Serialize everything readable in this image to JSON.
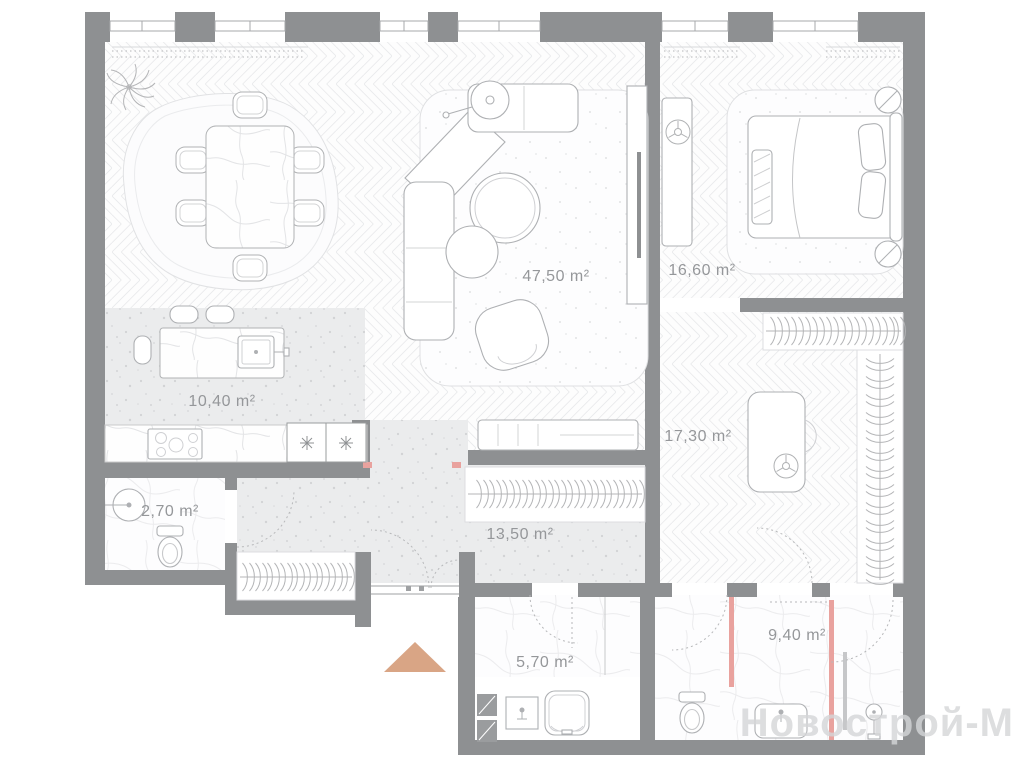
{
  "plan": {
    "watermark": "Новострой-М",
    "rooms": [
      {
        "name": "living-dining-room",
        "area_label": "47,50 m²"
      },
      {
        "name": "bedroom",
        "area_label": "16,60 m²"
      },
      {
        "name": "dressing-room",
        "area_label": "17,30 m²"
      },
      {
        "name": "kitchen",
        "area_label": "10,40 m²"
      },
      {
        "name": "hallway",
        "area_label": "13,50 m²"
      },
      {
        "name": "wc",
        "area_label": "2,70 m²"
      },
      {
        "name": "bathroom",
        "area_label": "5,70 m²"
      },
      {
        "name": "master-bathroom",
        "area_label": "9,40 m²"
      }
    ],
    "icons": {
      "entrance_arrow": "triangle-up",
      "appliance_star": "✳",
      "hanger": "clothes-hanger"
    },
    "colors": {
      "walls": "#8e9092",
      "accent_pink": "#e9a29e",
      "entrance_arrow": "#d9a585",
      "floor_speckle": "#ebeced",
      "label_text": "#95979a",
      "watermark_text": "#d5d6d8"
    }
  }
}
